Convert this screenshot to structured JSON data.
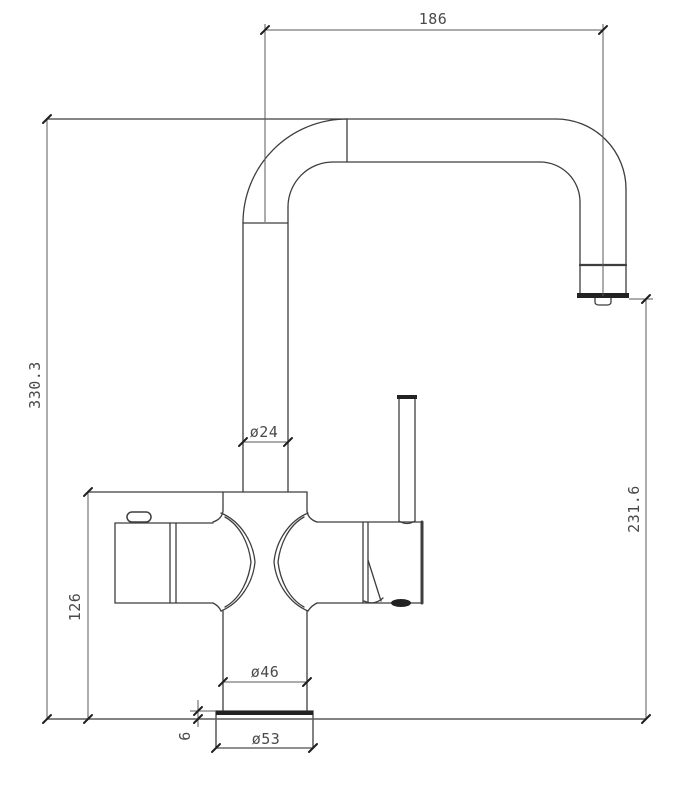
{
  "drawing": {
    "dimensions": {
      "spout_reach": {
        "label": "186"
      },
      "total_height": {
        "label": "330.3"
      },
      "outlet_height": {
        "label": "231.6"
      },
      "body_height": {
        "label": "126"
      },
      "spout_tube_diameter": {
        "label": "ø24"
      },
      "neck_diameter": {
        "label": "ø46"
      },
      "base_diameter": {
        "label": "ø53"
      },
      "base_plate_height": {
        "label": "6"
      }
    },
    "colors": {
      "line": "#3e3e3e",
      "dim": "#5a5a5a",
      "tick": "#1f1f1f",
      "dark": "#222222",
      "text": "#4a4a4a",
      "background": "#ffffff"
    }
  }
}
